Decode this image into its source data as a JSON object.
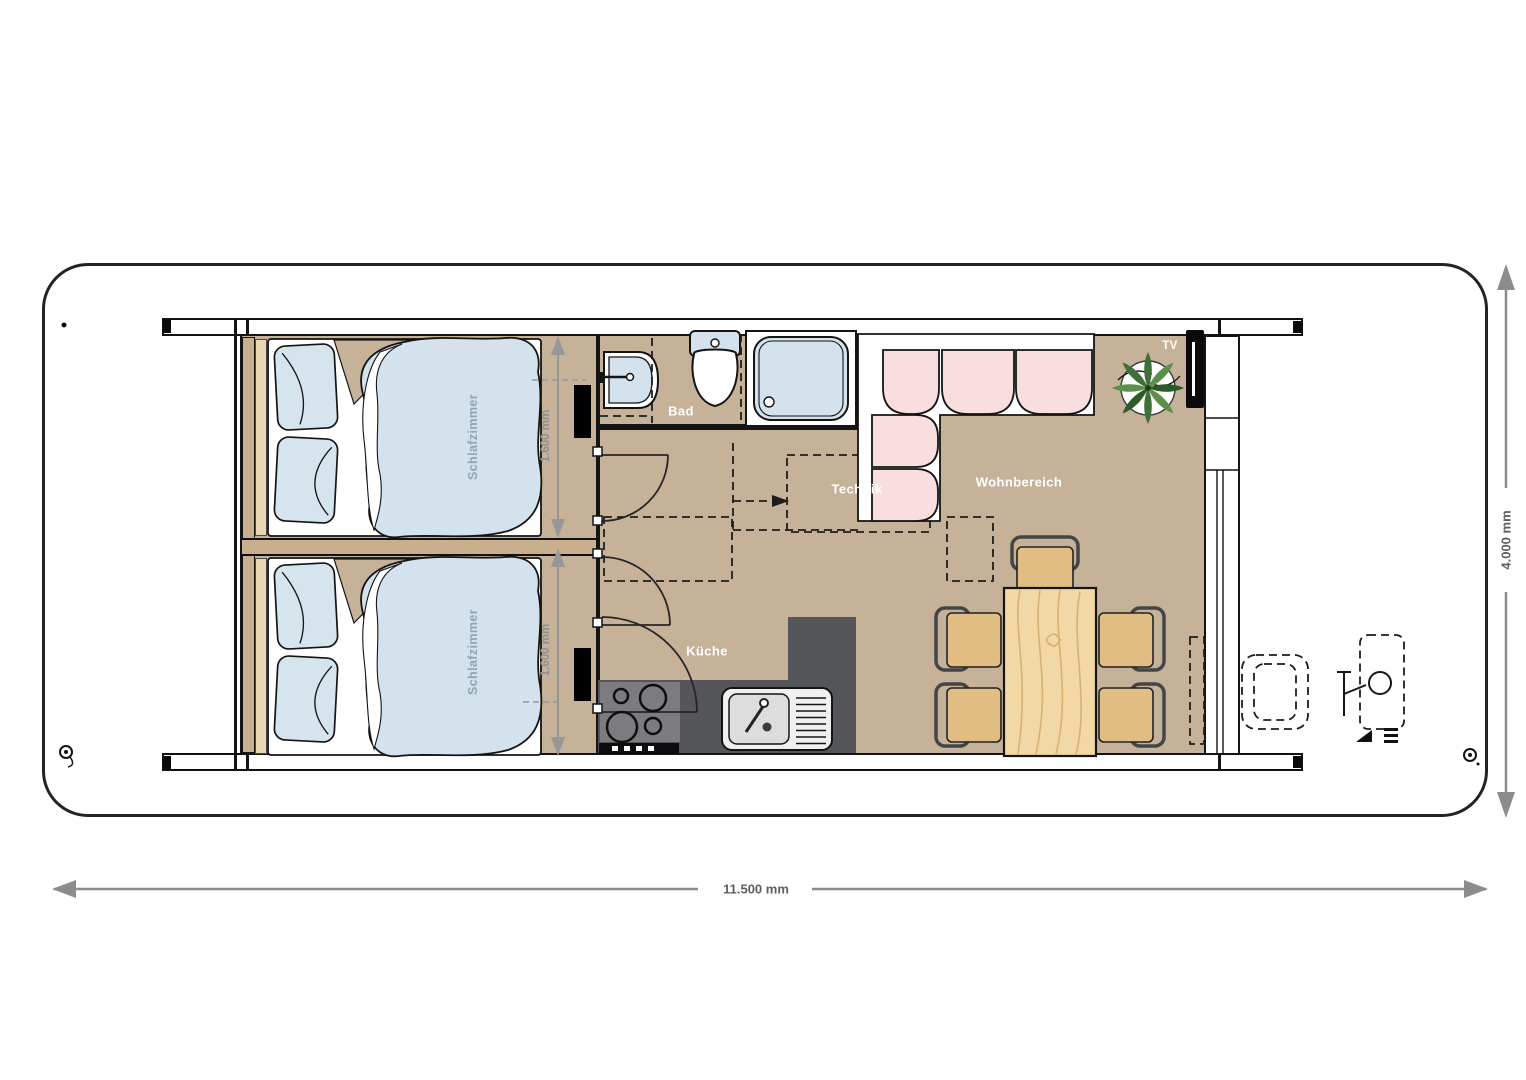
{
  "plan": {
    "type": "houseboat-floorplan",
    "rooms": {
      "bedroom1": {
        "label": "Schlafzimmer"
      },
      "bedroom2": {
        "label": "Schlafzimmer"
      },
      "bathroom": {
        "label": "Bad"
      },
      "technik": {
        "label": "Technik"
      },
      "kitchen": {
        "label": "Küche"
      },
      "living": {
        "label": "Wohnbereich"
      },
      "tv": {
        "label": "TV"
      }
    },
    "dimensions": {
      "overall_length": "11.500 mm",
      "overall_width": "4.000 mm",
      "bedroom1_width": "1.600 mm",
      "bedroom2_width": "1.600 mm"
    },
    "colors": {
      "floor_tan": "#c5b298",
      "wall_wood": "#c9af8c",
      "bed_blue": "#d3e2ec",
      "sofa_pink": "#f8dede",
      "counter_dark_gray": "#55565a",
      "table_wood": "#f2d8a4",
      "plant_green": "#3f7038",
      "dimension_gray": "#8c8c8c",
      "room_label_white": "#ffffff",
      "bedroom_label_blue_gray": "#91a5b4"
    }
  }
}
